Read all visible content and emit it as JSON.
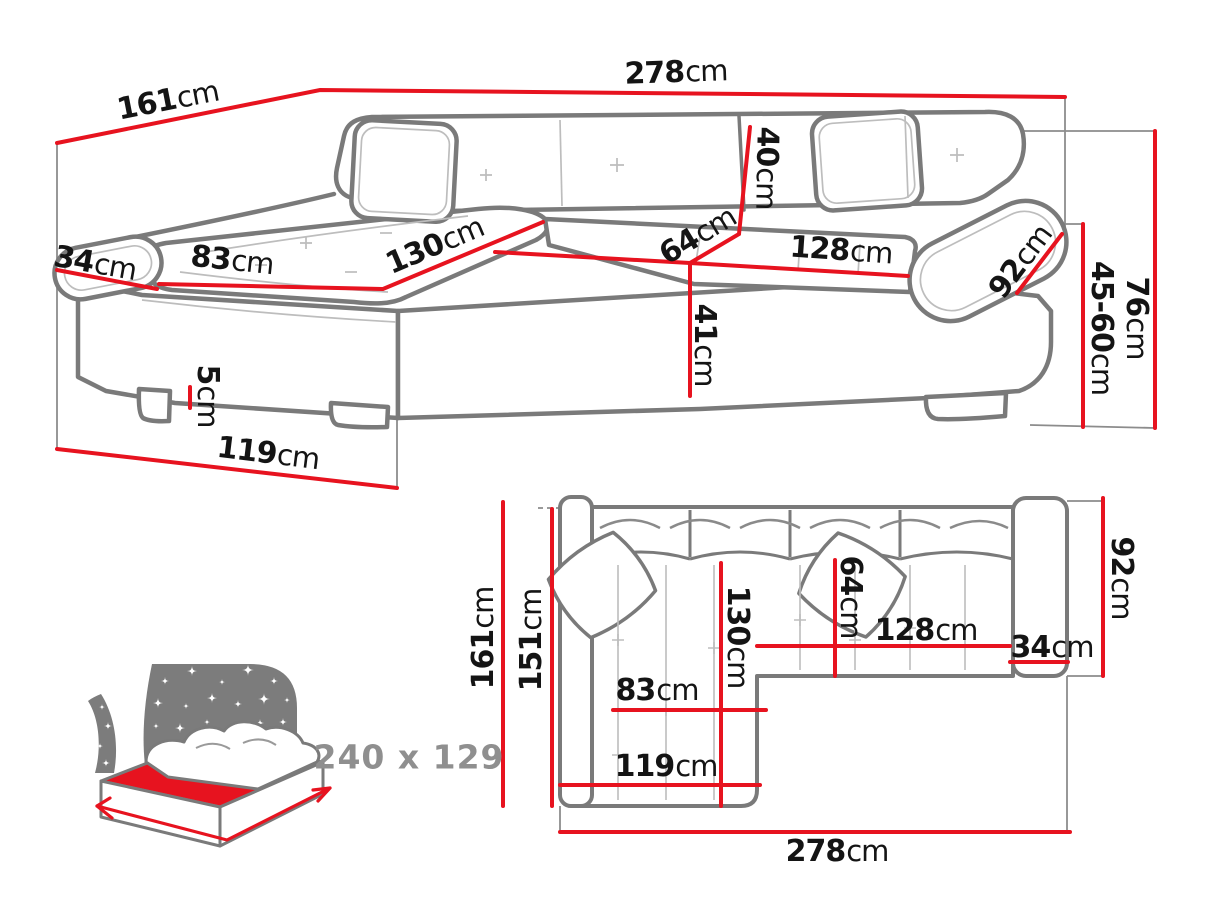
{
  "diagram_type": "corner-sofa-dimensions-diagram",
  "colors": {
    "dimension_line": "#e7131f",
    "sofa_outline": "#7a7a7a",
    "sketch_lines": "#bdbdbd",
    "label_text": "#141414",
    "icon_gray": "#7c7c7c",
    "icon_label_gray": "#8f8f8f",
    "background": "#ffffff"
  },
  "perspective_view": {
    "d161": {
      "value": "161",
      "unit": "cm"
    },
    "d278": {
      "value": "278",
      "unit": "cm"
    },
    "d40": {
      "value": "40",
      "unit": "cm"
    },
    "d34": {
      "value": "34",
      "unit": "cm"
    },
    "d83": {
      "value": "83",
      "unit": "cm"
    },
    "d130": {
      "value": "130",
      "unit": "cm"
    },
    "d64": {
      "value": "64",
      "unit": "cm"
    },
    "d128": {
      "value": "128",
      "unit": "cm"
    },
    "d92": {
      "value": "92",
      "unit": "cm"
    },
    "d76": {
      "value": "76",
      "unit": "cm"
    },
    "d45_60": {
      "value": "45-60",
      "unit": "cm"
    },
    "d41": {
      "value": "41",
      "unit": "cm"
    },
    "d5": {
      "value": "5",
      "unit": "cm"
    },
    "d119": {
      "value": "119",
      "unit": "cm"
    }
  },
  "plan_view": {
    "d161": {
      "value": "161",
      "unit": "cm"
    },
    "d151": {
      "value": "151",
      "unit": "cm"
    },
    "d130": {
      "value": "130",
      "unit": "cm"
    },
    "d64": {
      "value": "64",
      "unit": "cm"
    },
    "d128": {
      "value": "128",
      "unit": "cm"
    },
    "d34": {
      "value": "34",
      "unit": "cm"
    },
    "d92": {
      "value": "92",
      "unit": "cm"
    },
    "d83": {
      "value": "83",
      "unit": "cm"
    },
    "d119": {
      "value": "119",
      "unit": "cm"
    },
    "d278": {
      "value": "278",
      "unit": "cm"
    }
  },
  "sleeping_area_icon": {
    "icon": "bed-sleeping-function-icon",
    "size_label": "240 x 129"
  }
}
